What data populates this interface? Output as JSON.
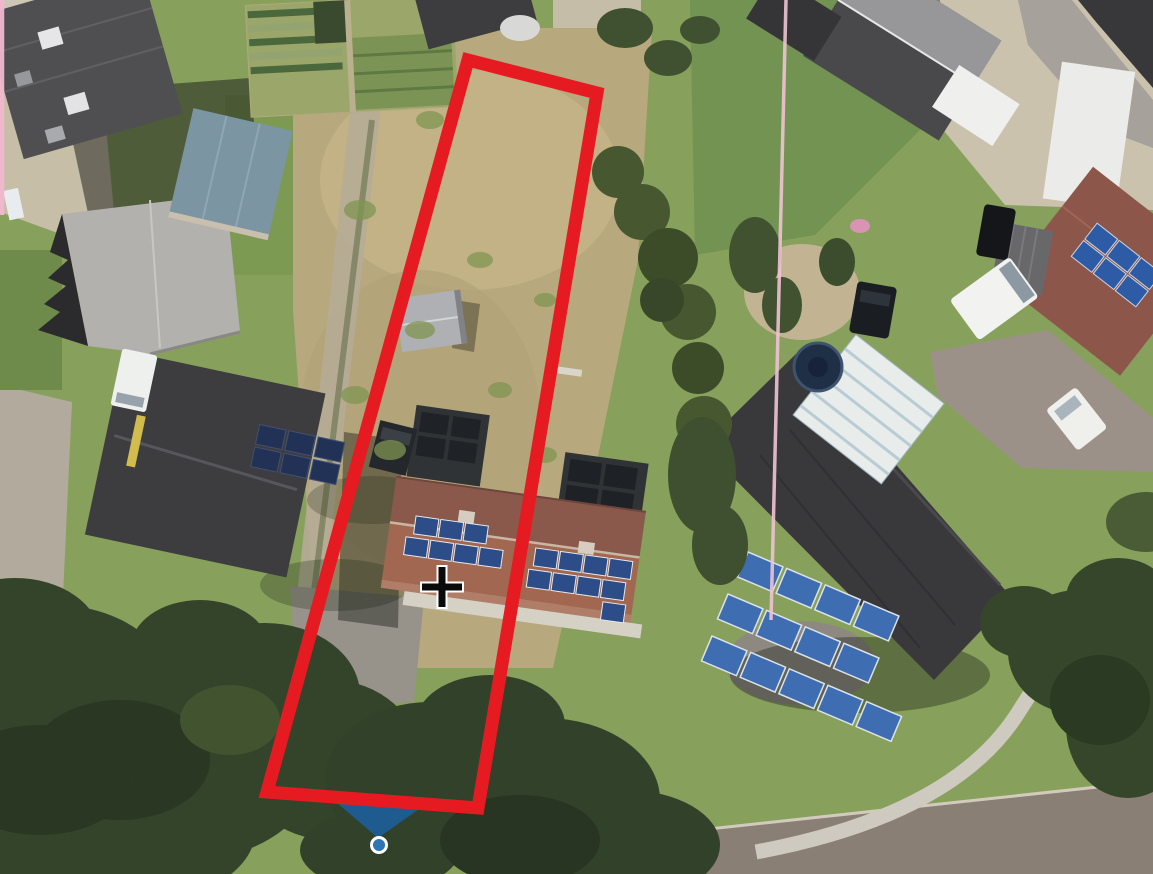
{
  "meta": {
    "app": "aerial-map-viewer",
    "canvas": {
      "width": 1153,
      "height": 874
    }
  },
  "overlay": {
    "parcel_outline": {
      "points": "468,60 597,93 478,808 267,792",
      "stroke": "#e61b22",
      "stroke_width": 13,
      "fill": "none"
    },
    "boundary_line_left": {
      "x1": 2,
      "y1": -4,
      "x2": 2,
      "y2": 215,
      "stroke": "#f3b8cf",
      "stroke_width": 4.5,
      "opacity": 0.95
    },
    "boundary_line_right": {
      "x1": 786,
      "y1": 0,
      "x2": 771,
      "y2": 620,
      "stroke": "#efc3d4",
      "stroke_width": 3.5,
      "opacity": 0.9
    },
    "direction_wedge": {
      "points": "322,790 432,800 378,838",
      "fill": "#1b5fa0",
      "opacity": 0.85
    },
    "vertex_marker": {
      "cx": 379,
      "cy": 845,
      "r": 7.5,
      "fill": "#2e75b6",
      "stroke": "#ffffff",
      "stroke_width": 3
    },
    "crosshair_cursor": {
      "cx": 442,
      "cy": 587,
      "transform": "translate(442,587)",
      "color": "#0a0a0a",
      "halo": "#ffffff"
    }
  }
}
